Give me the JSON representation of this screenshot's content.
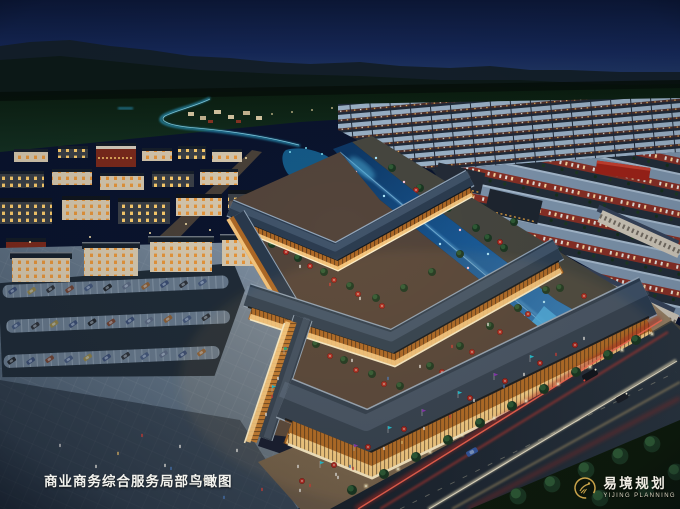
{
  "caption": {
    "text": "商业商务综合服务局部鸟瞰图"
  },
  "logo": {
    "name_zh": "易境规划",
    "name_en": "YIJING PLANNING",
    "emblem": "gold-ring-leaf-emblem"
  },
  "palette": {
    "sky_top": "#0c1838",
    "sky_horizon": "#2a4470",
    "mountain": "#14202b",
    "farmland": "#0e2213",
    "water_glow": "#46b4dc",
    "canal_deep": "#0d3866",
    "canal_bright": "#49b0e8",
    "roof_slate": "#2c3d51",
    "roof_distant": "#9db4ca",
    "facade_amber": "#e89a40",
    "window_warm": "#ffd288",
    "storefront_glow": "#fff3cf",
    "red_building": "#7c2a1c",
    "umbrella_red": "#b22d24",
    "asphalt": "#202c38",
    "plaza_light": "#8a9aac",
    "plaza_dark": "#3c4c5e",
    "light_trail_red": "#ff6a54",
    "light_trail_white": "#fff6dc",
    "tree_green": "#1b3822",
    "lawn_green": "#0e1b0b",
    "logo_gold": "#c9a34a",
    "caption_white": "#f4f4ef"
  }
}
